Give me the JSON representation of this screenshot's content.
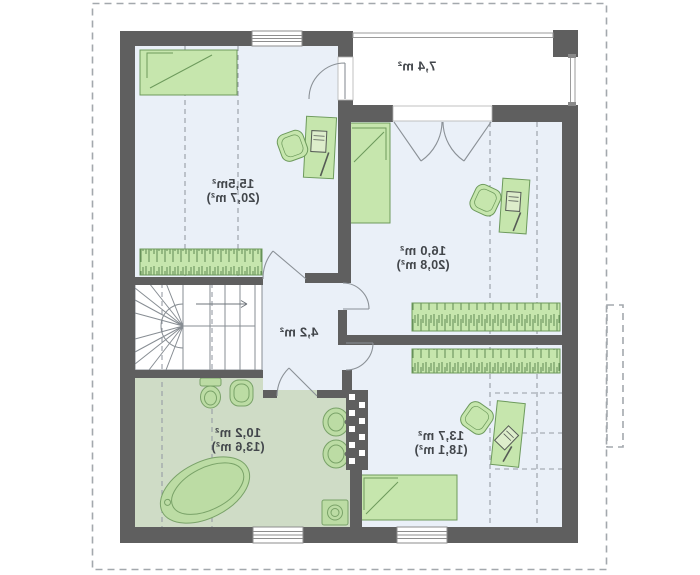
{
  "labels": {
    "bedroom_top_left": {
      "area_floor": "15,5m²",
      "area_total": "(20,7 m²)"
    },
    "bedroom_right": {
      "area_floor": "16,0 m²",
      "area_total": "(20,8 m²)"
    },
    "bedroom_bottom": {
      "area_floor": "13,7 m²",
      "area_total": "(18,1 m²)"
    },
    "bathroom": {
      "area_floor": "10,2 m²",
      "area_total": "(13,6 m²)"
    },
    "hall": {
      "area_floor": "4,2 m²"
    },
    "balcony": {
      "area_floor": "7,4 m²"
    }
  },
  "colors": {
    "wall": "#5f5f5f",
    "room_floor": "#eaf0f8",
    "bathroom_floor": "#cfdcc6",
    "furniture_fill": "#c6e6ad",
    "furniture_stroke": "#6d9a5c",
    "fixture_fill": "#bcdca4",
    "dashed_line": "#979da5",
    "roof_outline": "#a3a8ad",
    "label_text": "#42464b"
  },
  "icons": [
    "bed-icon",
    "desk-icon",
    "office-chair-icon",
    "laptop-icon",
    "wardrobe-icon",
    "stairs-icon",
    "toilet-icon",
    "bidet-icon",
    "sink-icon",
    "bathtub-icon",
    "washing-machine-icon",
    "window-icon",
    "door-swing-icon",
    "railing-icon",
    "chimney-icon"
  ]
}
